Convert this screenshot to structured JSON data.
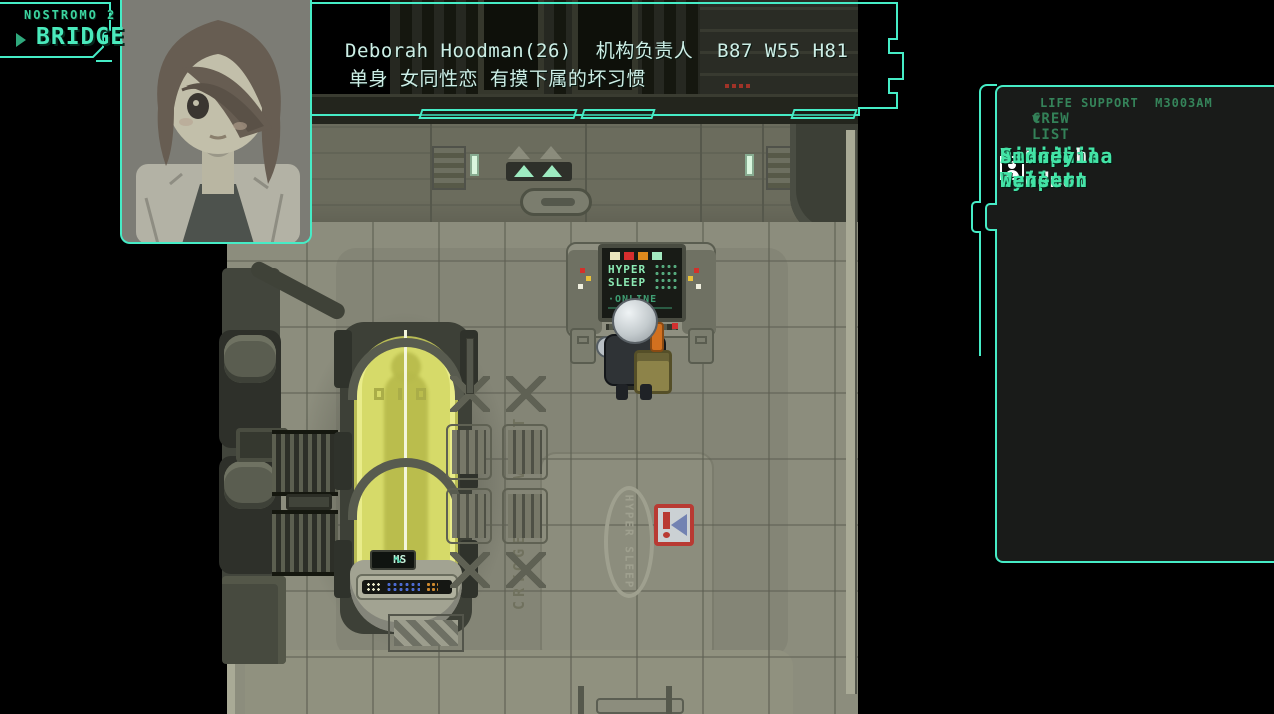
{
  "hud": {
    "ship": "NOSTROMO 2",
    "location": "BRIDGE"
  },
  "dialog": {
    "line1": "Deborah Hoodman(26)  机构负责人  B87 W55 H81",
    "line2": "单身 女同性恋 有摸下属的坏习惯"
  },
  "panel": {
    "system_label": "LIFE SUPPORT  M3003AM",
    "arrow": "▼",
    "list_label": "CREW LIST"
  },
  "crew": {
    "members": [
      "Aimee Dris",
      "Gabriella Conie",
      "Lilian Reiser",
      "Veronica Wenser",
      "Jenna Lampart",
      "Deborah Hoodman",
      "Seraphina Bullet",
      "Helena Paxeton",
      "Amanda Dyne",
      "Sidney Wenser"
    ],
    "selected": "Deborah Hoodman",
    "selected_index": 5
  },
  "map": {
    "console_line1": "HYPER",
    "console_line2": "SLEEP",
    "console_status": "·ONLINE",
    "pod_monitor": "HS",
    "pod_wave": "∿",
    "vault_label": "CRYOGENIC VAULT",
    "floor_sign": "HYPER SLEEP",
    "alert_exclaim": "!"
  },
  "colors": {
    "ui_teal": "#46ecc6",
    "crew_green": "#43e4a6",
    "header_green": "#35845a",
    "dialog_text": "#cdeee6",
    "selected_white": "#f4f4f4",
    "cryo_yellow": "#d6da69",
    "alert_red": "#b93a33",
    "floor_gray": "#8c8d7d"
  }
}
